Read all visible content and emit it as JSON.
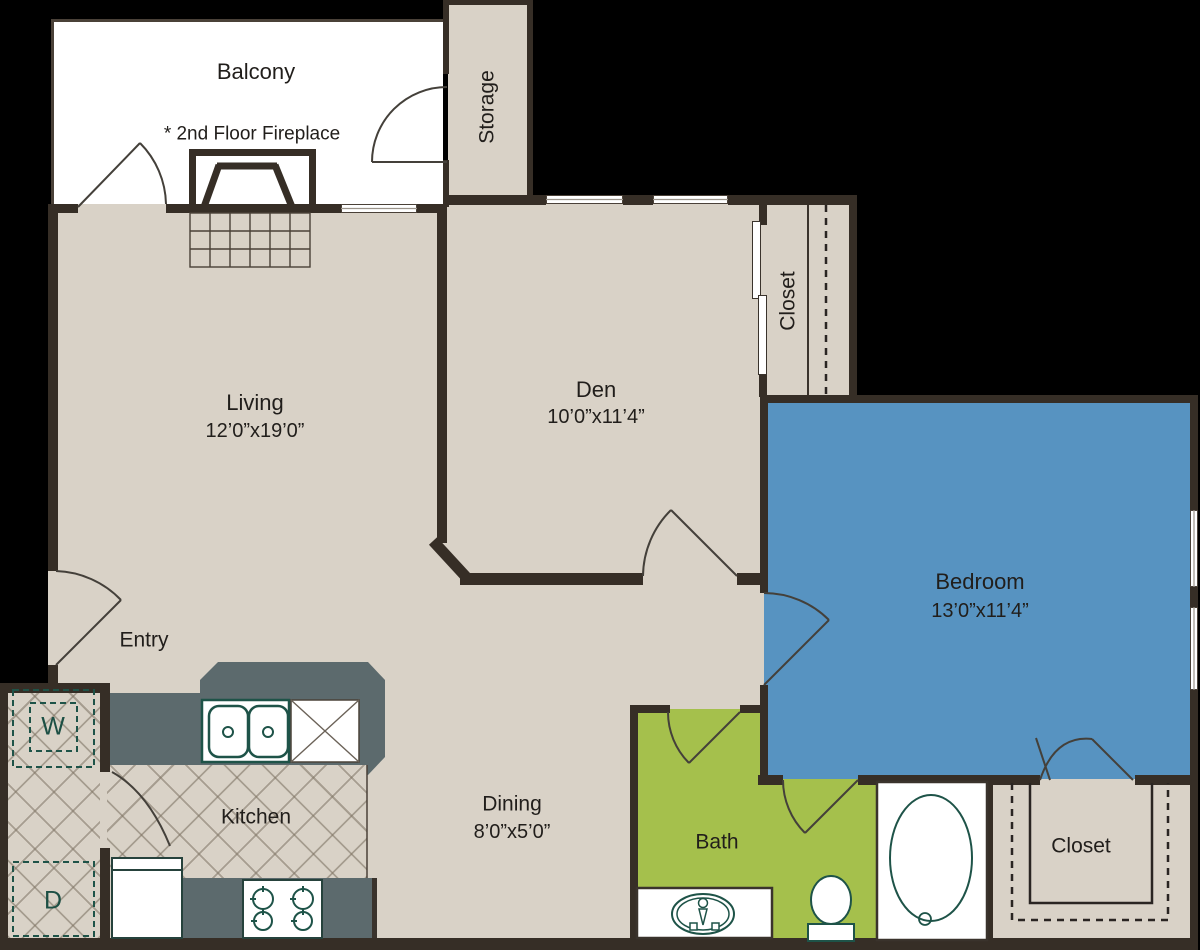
{
  "title": "One-bedroom with den floor plan",
  "rooms": {
    "balcony": {
      "name": "Balcony"
    },
    "fireplace_note": "* 2nd Floor Fireplace",
    "storage": {
      "name": "Storage"
    },
    "living": {
      "name": "Living",
      "dims": "12’0”x19’0”"
    },
    "den": {
      "name": "Den",
      "dims": "10’0”x11’4”"
    },
    "hall_closet": {
      "name": "Closet"
    },
    "bedroom": {
      "name": "Bedroom",
      "dims": "13’0”x11’4”"
    },
    "entry": {
      "name": "Entry"
    },
    "kitchen": {
      "name": "Kitchen"
    },
    "dining": {
      "name": "Dining",
      "dims": "8’0”x5’0”"
    },
    "bath": {
      "name": "Bath"
    },
    "bedroom_closet": {
      "name": "Closet"
    },
    "laundry": {
      "washer": "W",
      "dryer": "D"
    }
  },
  "colors": {
    "background": "#000000",
    "floor": "#d9d2c7",
    "balcony": "#ffffff",
    "wall": "#362e26",
    "bedroom": "#5793c1",
    "bath": "#a5c04c",
    "counter": "#5c6a6d",
    "fixture": "#1e5348"
  }
}
